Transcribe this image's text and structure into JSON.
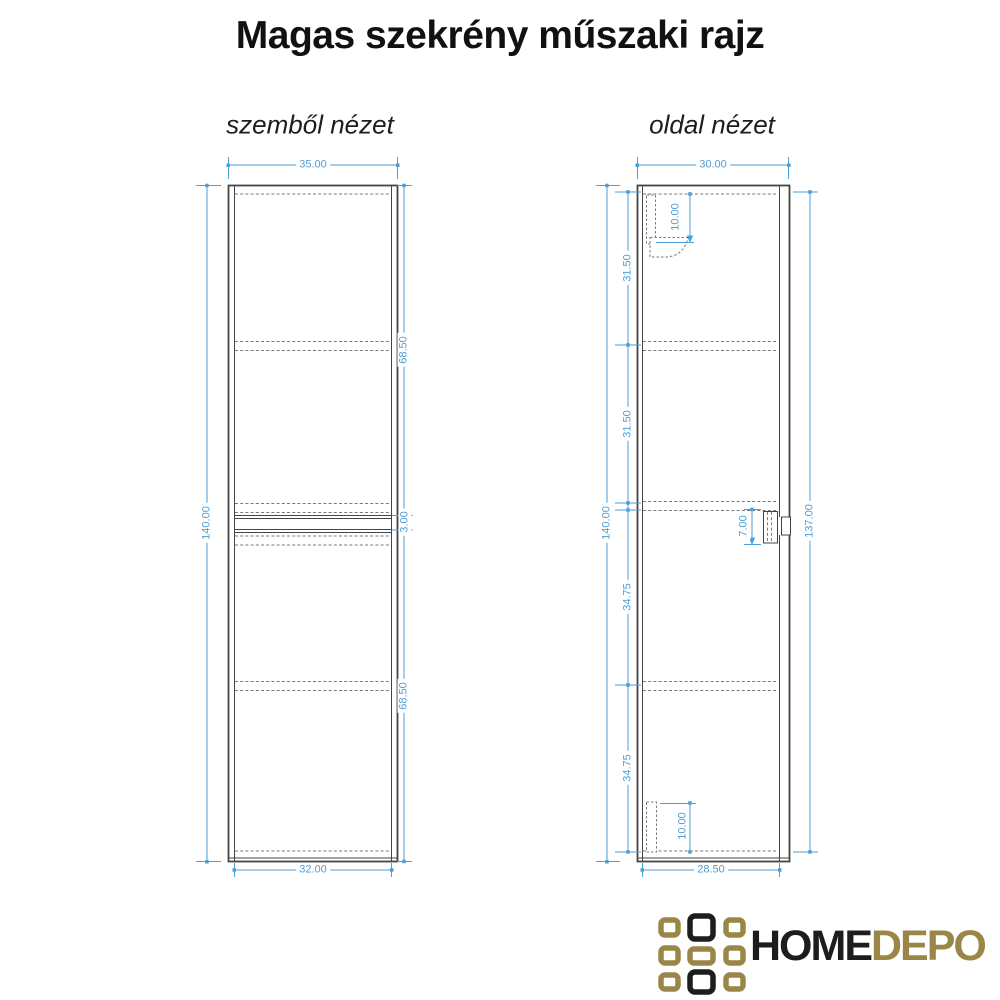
{
  "title": "Magas szekrény műszaki rajz",
  "views": {
    "front": {
      "label": "szemből nézet",
      "dimensions": {
        "top_width": "35.00",
        "height": "140.00",
        "upper_section": "68.50",
        "gap": "3.00",
        "lower_section": "68.50",
        "bottom_width": "32.00"
      }
    },
    "side": {
      "label": "oldal nézet",
      "dimensions": {
        "top_depth": "30.00",
        "height": "140.00",
        "segments": [
          "31.50",
          "31.50",
          "34.75",
          "34.75"
        ],
        "door_height": "137.00",
        "top_inset": "10.00",
        "mid_inset": "7.00",
        "bottom_inset": "10.00",
        "bottom_depth": "28.50"
      }
    }
  },
  "logo": {
    "text_primary": "HOME",
    "text_secondary": "DEPO",
    "grid_pattern": [
      [
        "gold",
        "black",
        "gold"
      ],
      [
        "gold",
        "gold",
        "gold"
      ],
      [
        "gold",
        "black",
        "gold"
      ]
    ]
  },
  "colors": {
    "dimension": "#4e9ed6",
    "line": "#454545",
    "dash": "#7a7a7a",
    "logo_gold": "#9a8748",
    "logo_black": "#1d1d1b"
  }
}
